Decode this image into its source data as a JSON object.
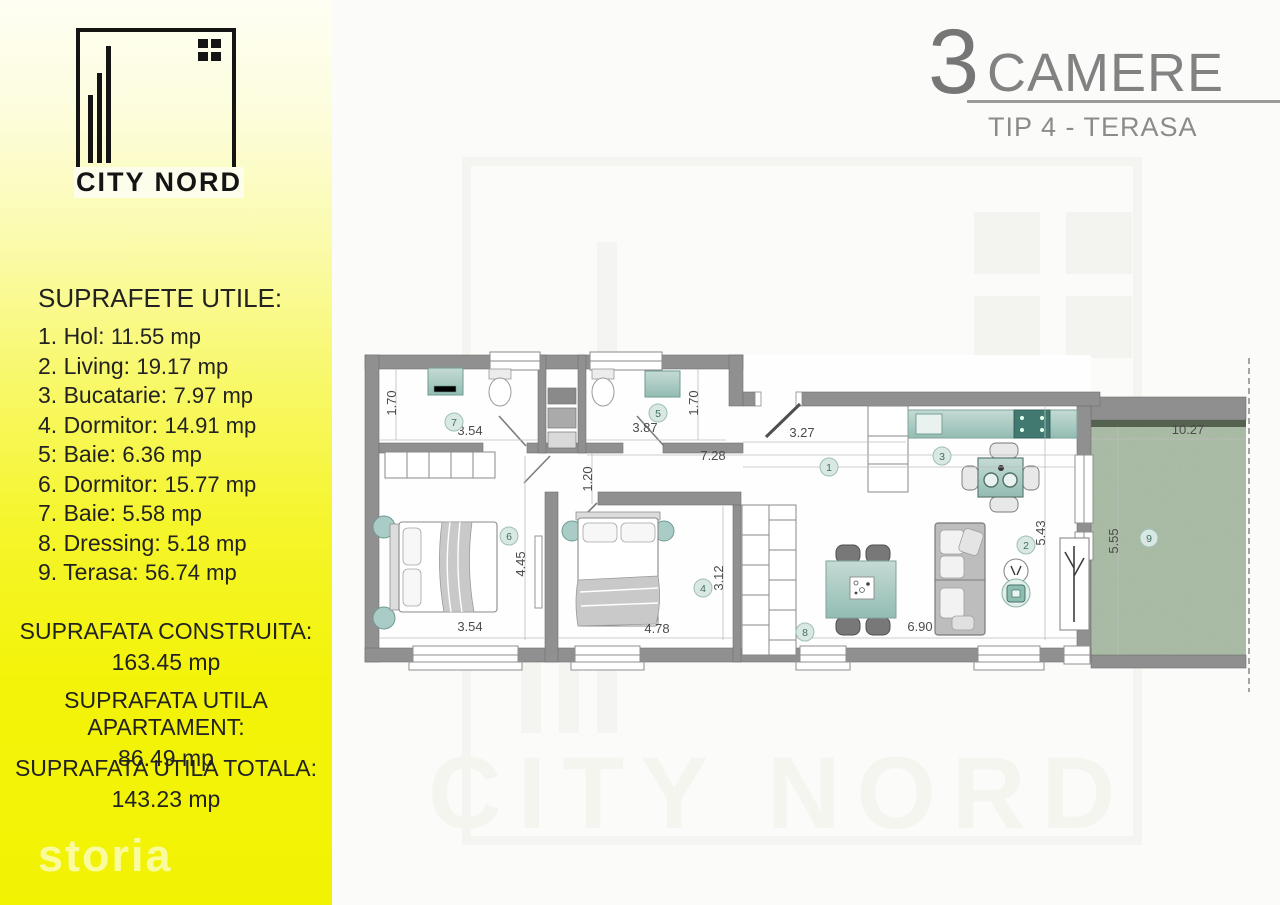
{
  "branding": {
    "logo_text": "CITY NORD",
    "storia_logo": "storia"
  },
  "header": {
    "rooms_count": "3",
    "rooms_label": "CAMERE",
    "subtitle": "TIP 4 - TERASA"
  },
  "sidebar": {
    "title": "SUPRAFETE UTILE:",
    "rooms": [
      {
        "label": "1. Hol:",
        "value": "11.55 mp"
      },
      {
        "label": "2. Living:",
        "value": "19.17 mp"
      },
      {
        "label": "3. Bucatarie:",
        "value": "7.97 mp"
      },
      {
        "label": "4. Dormitor:",
        "value": "14.91 mp"
      },
      {
        "label": "5: Baie:",
        "value": "6.36 mp"
      },
      {
        "label": "6. Dormitor:",
        "value": "15.77 mp"
      },
      {
        "label": "7. Baie:",
        "value": "5.58 mp"
      },
      {
        "label": "8. Dressing:",
        "value": "5.18 mp"
      },
      {
        "label": "9. Terasa:",
        "value": "56.74 mp"
      }
    ],
    "totals": [
      {
        "label": "SUPRAFATA CONSTRUITA:",
        "value": "163.45 mp"
      },
      {
        "label": "SUPRAFATA UTILA APARTAMENT:",
        "value": "86.49 mp"
      },
      {
        "label": "SUPRAFATA UTILA TOTALA:",
        "value": "143.23 mp"
      }
    ]
  },
  "watermark": {
    "text": "CITY NORD"
  },
  "plan": {
    "dimensions": [
      "1.70",
      "3.54",
      "3.87",
      "1.70",
      "7.28",
      "3.27",
      "1.20",
      "4.45",
      "3.54",
      "4.78",
      "3.12",
      "6.90",
      "5.43",
      "10.27",
      "5.55"
    ],
    "markers": [
      "7",
      "5",
      "6",
      "4",
      "1",
      "3",
      "2",
      "8",
      "9"
    ],
    "colors": {
      "wall": "#909090",
      "fixture_teal": "#a9cdc6",
      "terrace_green": "#adbfa8",
      "marker_fill": "#d9e8e3"
    }
  }
}
